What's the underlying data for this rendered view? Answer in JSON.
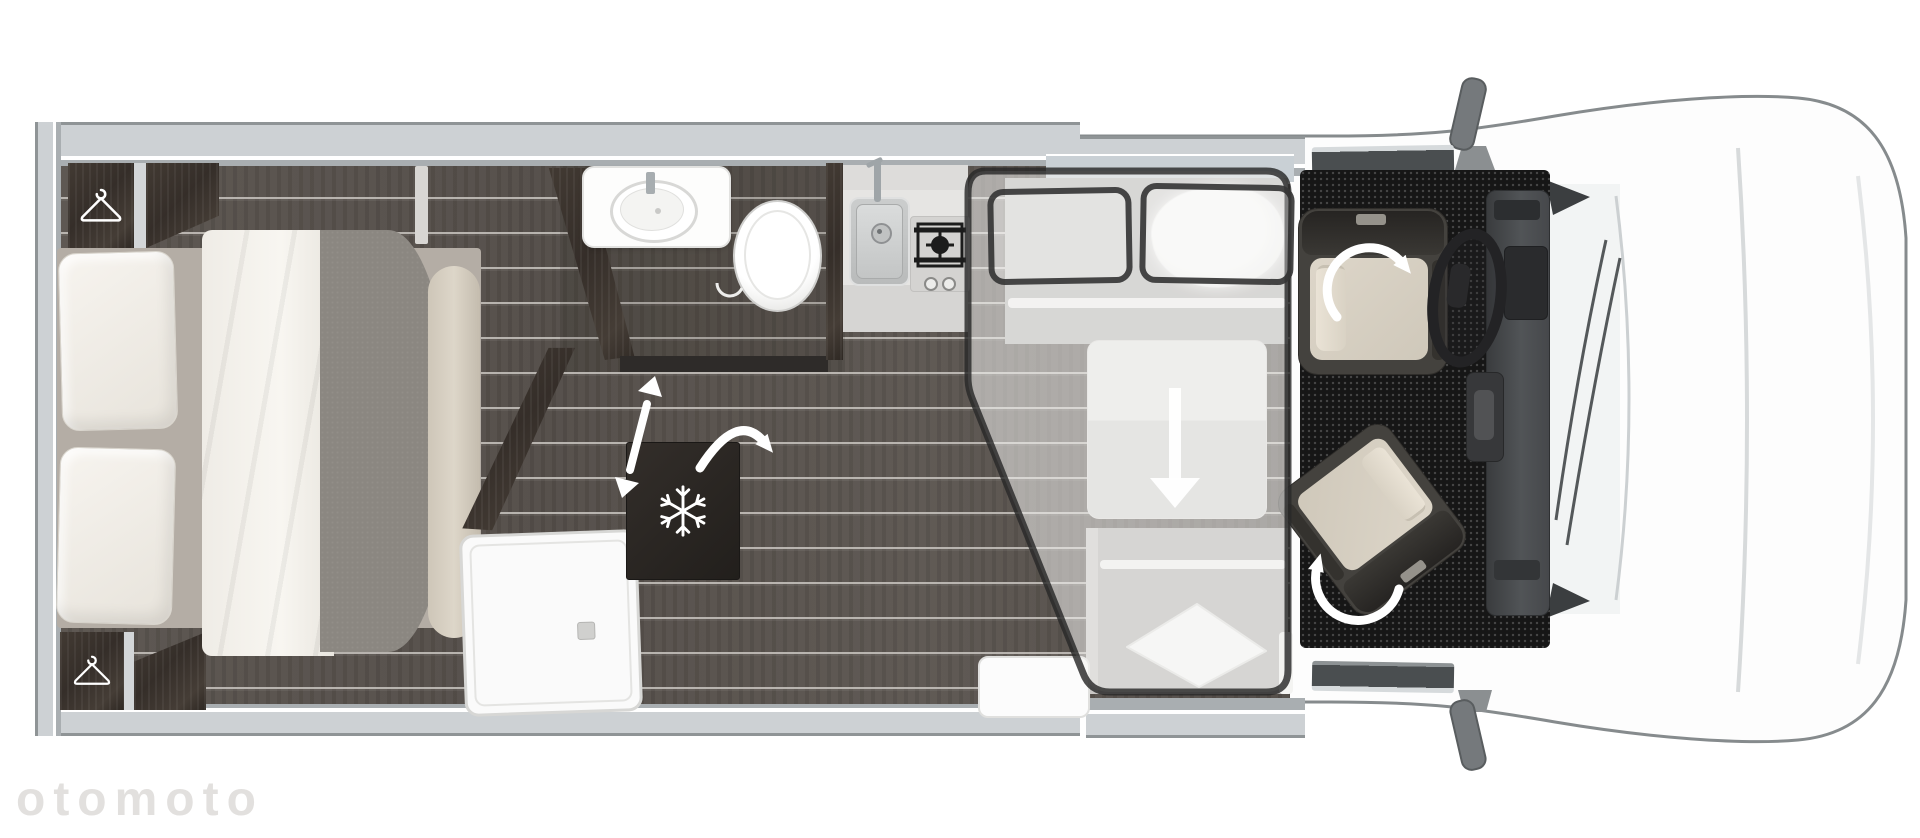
{
  "page": {
    "title": "Motorhome layout floor plan (top view)",
    "background": "#ffffff",
    "watermark": "otomoto"
  },
  "floorplan": {
    "view": "top-down",
    "vehicle": "coachbuilt motorhome",
    "zones": [
      {
        "id": "bedroom",
        "label": "Rear bedroom",
        "items": [
          "double bed",
          "two pillows",
          "white sheet",
          "grey duvet",
          "wardrobe with hanger (top)",
          "wardrobe with hanger (bottom)"
        ]
      },
      {
        "id": "bathroom",
        "label": "Bathroom",
        "items": [
          "washbasin with tap",
          "toilet",
          "shower tray with drain",
          "sliding-door double arrow",
          "door swing arrow",
          "hinge arc"
        ]
      },
      {
        "id": "kitchen",
        "label": "Kitchen",
        "items": [
          "stainless steel sink with tap",
          "gas hob with grate",
          "two control knobs",
          "refrigerator with snowflake"
        ]
      },
      {
        "id": "lounge",
        "label": "Dinette with drop-down bed",
        "items": [
          "front bench",
          "rear bench with pillow",
          "table",
          "drop-down bed outline",
          "two outlined bed pillows",
          "lowering arrow",
          "entry step"
        ]
      },
      {
        "id": "cab",
        "label": "Driver cab",
        "items": [
          "driver swivel seat",
          "passenger swivel seat",
          "swivel rotation arrows",
          "steering wheel",
          "dashboard",
          "handbrake console",
          "wing mirrors",
          "windscreen wipers",
          "windscreen",
          "van nose"
        ]
      }
    ],
    "icons": [
      "hanger-icon",
      "snowflake-icon",
      "swivel-arrow-icon",
      "drop-arrow-icon",
      "slide-arrow-icon",
      "swing-arrow-icon"
    ],
    "colors": {
      "floor_wood": "#564f4a",
      "plank_line": "#c9c5c0",
      "furniture_wood": "#3a332d",
      "wall": "#cdd1d4",
      "overlay_border": "#2e2e2e",
      "cab_carpet": "#161616",
      "seat_cushion": "#d7d0c3",
      "body_outline": "#868b8d",
      "arrow_white": "#ffffff"
    }
  }
}
